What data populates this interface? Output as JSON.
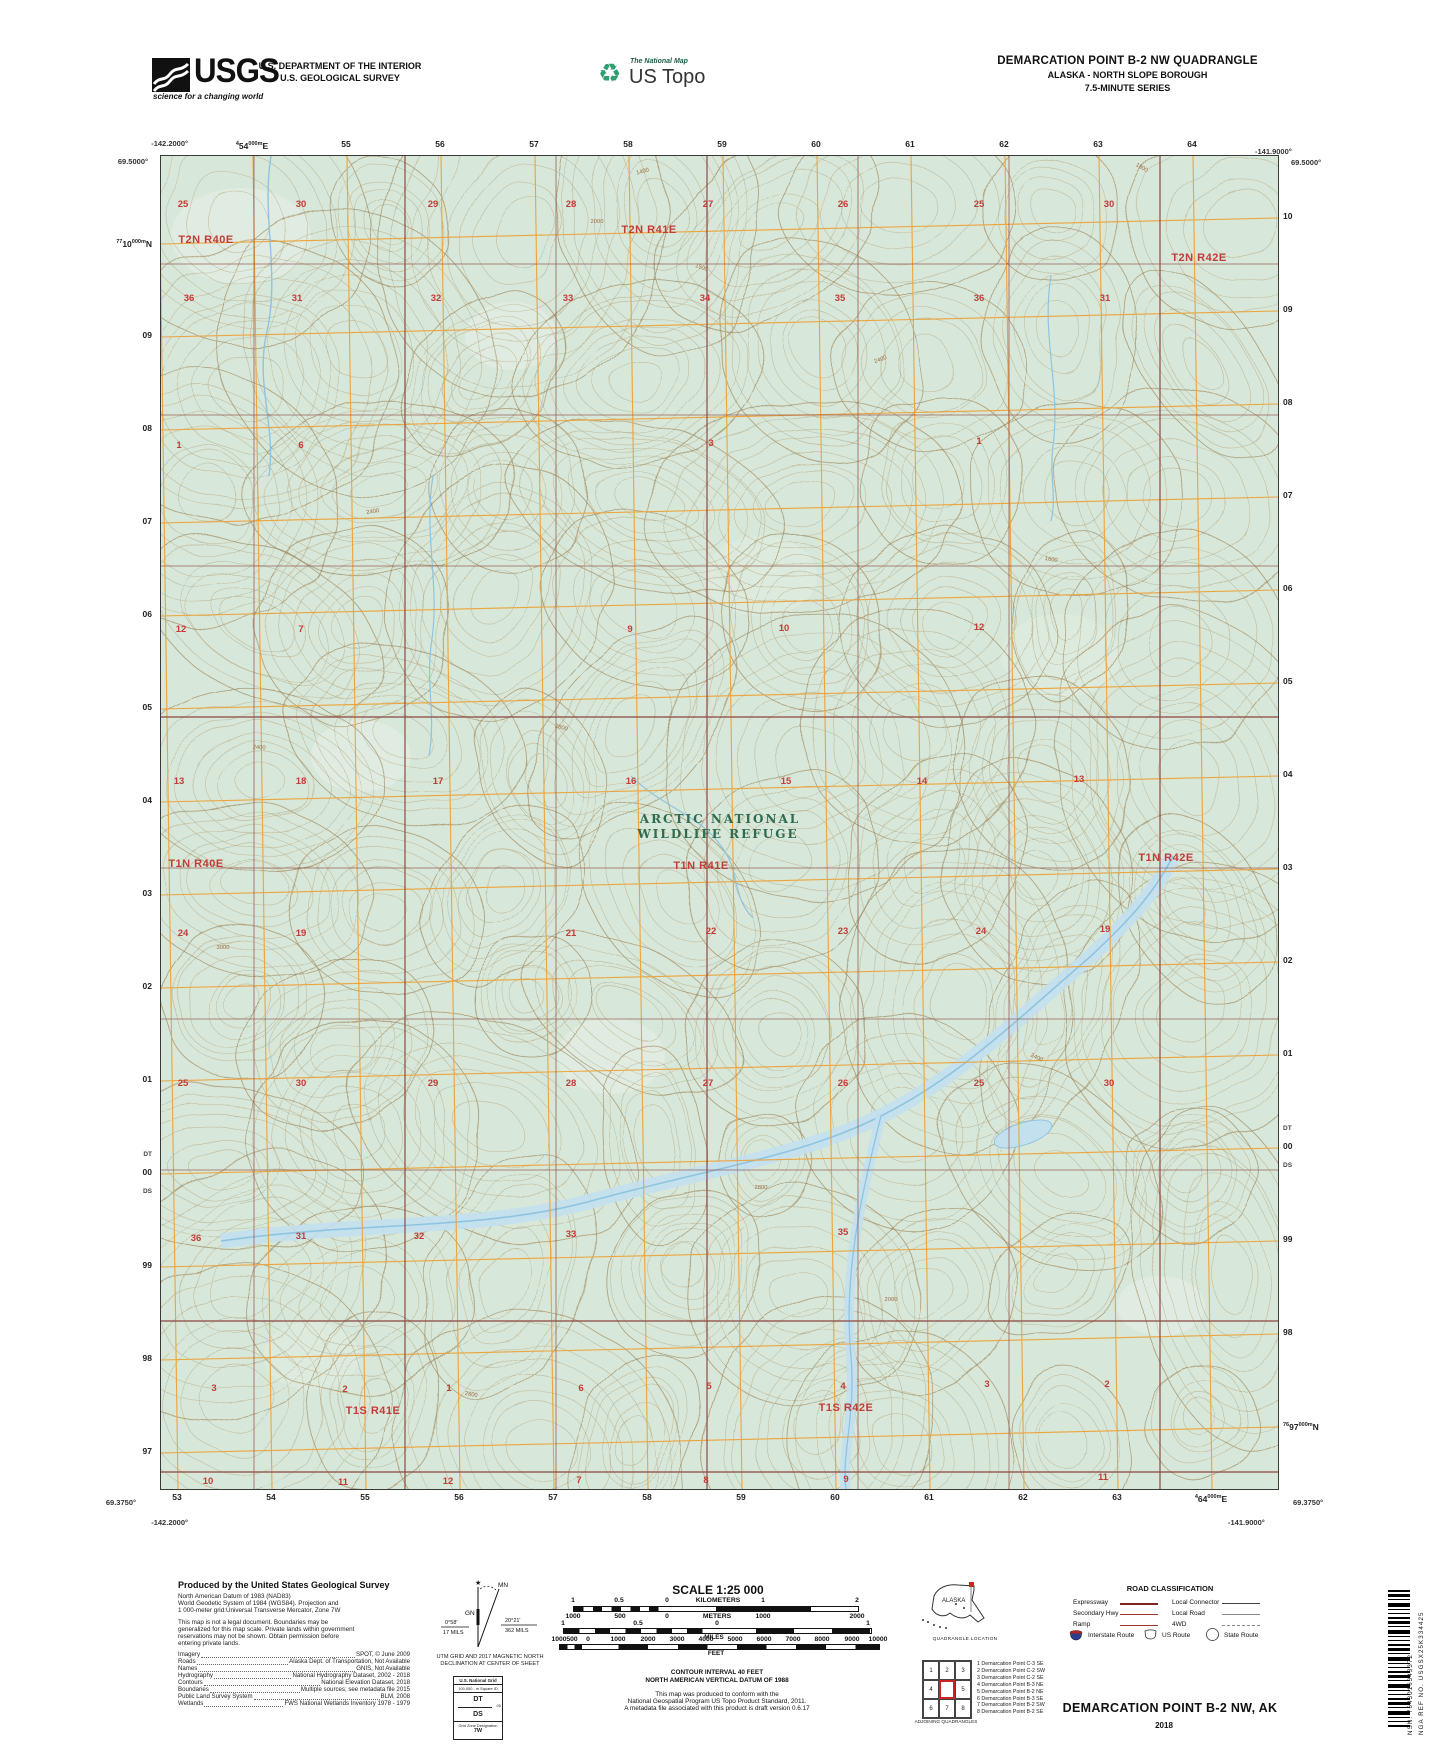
{
  "header": {
    "usgs": {
      "name": "USGS",
      "tagline": "science for a changing world"
    },
    "dept1": "U.S. DEPARTMENT OF THE INTERIOR",
    "dept2": "U.S. GEOLOGICAL SURVEY",
    "natmap": "The National Map",
    "ustopo": "US Topo",
    "q1": "DEMARCATION POINT B-2 NW QUADRANGLE",
    "q2": "ALASKA - NORTH SLOPE BOROUGH",
    "q3": "7.5-MINUTE SERIES"
  },
  "collar": {
    "corners": {
      "tl_lon": "-142.2000°",
      "tl_lat": "69.5000°",
      "tr_lon": "-141.9000°",
      "tr_lat": "69.5000°",
      "bl_lat": "69.3750°",
      "bl_lon": "-142.2000°",
      "br_lon": "-141.9000°",
      "br_lat": "69.3750°"
    },
    "top": [
      {
        "x": 252,
        "pre": "4",
        "t": "54",
        "sup": "000m",
        "suf": "E"
      },
      {
        "x": 346,
        "t": "55"
      },
      {
        "x": 440,
        "t": "56"
      },
      {
        "x": 534,
        "t": "57"
      },
      {
        "x": 628,
        "t": "58"
      },
      {
        "x": 722,
        "t": "59"
      },
      {
        "x": 816,
        "t": "60"
      },
      {
        "x": 910,
        "t": "61"
      },
      {
        "x": 1004,
        "t": "62"
      },
      {
        "x": 1098,
        "t": "63"
      },
      {
        "x": 1192,
        "t": "64"
      }
    ],
    "bottom": [
      {
        "x": 177,
        "t": "53"
      },
      {
        "x": 271,
        "t": "54"
      },
      {
        "x": 365,
        "t": "55"
      },
      {
        "x": 459,
        "t": "56"
      },
      {
        "x": 553,
        "t": "57"
      },
      {
        "x": 647,
        "t": "58"
      },
      {
        "x": 741,
        "t": "59"
      },
      {
        "x": 835,
        "t": "60"
      },
      {
        "x": 929,
        "t": "61"
      },
      {
        "x": 1023,
        "t": "62"
      },
      {
        "x": 1117,
        "t": "63"
      },
      {
        "x": 1211,
        "pre": "4",
        "t": "64",
        "sup": "000m",
        "suf": "E"
      }
    ],
    "left": [
      {
        "y": 243,
        "pre": "77",
        "t": "10",
        "sup": "000m",
        "suf": "N"
      },
      {
        "y": 336,
        "t": "09"
      },
      {
        "y": 429,
        "t": "08"
      },
      {
        "y": 522,
        "t": "07"
      },
      {
        "y": 615,
        "t": "06"
      },
      {
        "y": 708,
        "t": "05"
      },
      {
        "y": 801,
        "t": "04"
      },
      {
        "y": 894,
        "t": "03"
      },
      {
        "y": 987,
        "t": "02"
      },
      {
        "y": 1080,
        "t": "01"
      },
      {
        "y": 1155,
        "t": "DT",
        "sq": true
      },
      {
        "y": 1173,
        "t": "00"
      },
      {
        "y": 1192,
        "t": "DS",
        "sq": true
      },
      {
        "y": 1266,
        "t": "99"
      },
      {
        "y": 1359,
        "t": "98"
      },
      {
        "y": 1452,
        "t": "97"
      }
    ],
    "right": [
      {
        "y": 217,
        "t": "10"
      },
      {
        "y": 310,
        "t": "09"
      },
      {
        "y": 403,
        "t": "08"
      },
      {
        "y": 496,
        "t": "07"
      },
      {
        "y": 589,
        "t": "06"
      },
      {
        "y": 682,
        "t": "05"
      },
      {
        "y": 775,
        "t": "04"
      },
      {
        "y": 868,
        "t": "03"
      },
      {
        "y": 961,
        "t": "02"
      },
      {
        "y": 1054,
        "t": "01"
      },
      {
        "y": 1129,
        "t": "DT",
        "sq": true
      },
      {
        "y": 1147,
        "t": "00"
      },
      {
        "y": 1166,
        "t": "DS",
        "sq": true
      },
      {
        "y": 1240,
        "t": "99"
      },
      {
        "y": 1333,
        "t": "98"
      },
      {
        "y": 1426,
        "pre": "76",
        "t": "97",
        "sup": "000m",
        "suf": "N"
      }
    ]
  },
  "map": {
    "refuge1": "ARCTIC NATIONAL",
    "refuge2": "WILDLIFE REFUGE",
    "townships": [
      {
        "t": "T2N R40E",
        "x": 205,
        "y": 242
      },
      {
        "t": "T2N R41E",
        "x": 648,
        "y": 232
      },
      {
        "t": "T2N R42E",
        "x": 1198,
        "y": 260
      },
      {
        "t": "T1N R40E",
        "x": 195,
        "y": 866
      },
      {
        "t": "T1N R41E",
        "x": 700,
        "y": 868
      },
      {
        "t": "T1N R42E",
        "x": 1165,
        "y": 860
      },
      {
        "t": "T1S R41E",
        "x": 372,
        "y": 1413
      },
      {
        "t": "T1S R42E",
        "x": 845,
        "y": 1410
      }
    ],
    "sections": [
      {
        "t": "25",
        "x": 182,
        "y": 206
      },
      {
        "t": "30",
        "x": 300,
        "y": 206
      },
      {
        "t": "29",
        "x": 432,
        "y": 206
      },
      {
        "t": "28",
        "x": 570,
        "y": 206
      },
      {
        "t": "27",
        "x": 707,
        "y": 206
      },
      {
        "t": "26",
        "x": 842,
        "y": 206
      },
      {
        "t": "25",
        "x": 978,
        "y": 206
      },
      {
        "t": "30",
        "x": 1108,
        "y": 206
      },
      {
        "t": "36",
        "x": 188,
        "y": 300
      },
      {
        "t": "31",
        "x": 296,
        "y": 300
      },
      {
        "t": "32",
        "x": 435,
        "y": 300
      },
      {
        "t": "33",
        "x": 567,
        "y": 300
      },
      {
        "t": "34",
        "x": 704,
        "y": 300
      },
      {
        "t": "35",
        "x": 839,
        "y": 300
      },
      {
        "t": "36",
        "x": 978,
        "y": 300
      },
      {
        "t": "31",
        "x": 1104,
        "y": 300
      },
      {
        "t": "1",
        "x": 178,
        "y": 447
      },
      {
        "t": "6",
        "x": 300,
        "y": 447
      },
      {
        "t": "3",
        "x": 710,
        "y": 445
      },
      {
        "t": "1",
        "x": 978,
        "y": 443
      },
      {
        "t": "12",
        "x": 180,
        "y": 631
      },
      {
        "t": "7",
        "x": 300,
        "y": 631
      },
      {
        "t": "9",
        "x": 629,
        "y": 631
      },
      {
        "t": "10",
        "x": 783,
        "y": 630
      },
      {
        "t": "12",
        "x": 978,
        "y": 629
      },
      {
        "t": "13",
        "x": 178,
        "y": 783
      },
      {
        "t": "18",
        "x": 300,
        "y": 783
      },
      {
        "t": "17",
        "x": 437,
        "y": 783
      },
      {
        "t": "16",
        "x": 630,
        "y": 783
      },
      {
        "t": "15",
        "x": 785,
        "y": 783
      },
      {
        "t": "14",
        "x": 921,
        "y": 783
      },
      {
        "t": "13",
        "x": 1078,
        "y": 781
      },
      {
        "t": "24",
        "x": 182,
        "y": 935
      },
      {
        "t": "19",
        "x": 300,
        "y": 935
      },
      {
        "t": "21",
        "x": 570,
        "y": 935
      },
      {
        "t": "22",
        "x": 710,
        "y": 933
      },
      {
        "t": "23",
        "x": 842,
        "y": 933
      },
      {
        "t": "24",
        "x": 980,
        "y": 933
      },
      {
        "t": "19",
        "x": 1104,
        "y": 931
      },
      {
        "t": "25",
        "x": 182,
        "y": 1085
      },
      {
        "t": "30",
        "x": 300,
        "y": 1085
      },
      {
        "t": "29",
        "x": 432,
        "y": 1085
      },
      {
        "t": "28",
        "x": 570,
        "y": 1085
      },
      {
        "t": "27",
        "x": 707,
        "y": 1085
      },
      {
        "t": "26",
        "x": 842,
        "y": 1085
      },
      {
        "t": "25",
        "x": 978,
        "y": 1085
      },
      {
        "t": "30",
        "x": 1108,
        "y": 1085
      },
      {
        "t": "36",
        "x": 195,
        "y": 1240
      },
      {
        "t": "31",
        "x": 300,
        "y": 1238
      },
      {
        "t": "32",
        "x": 418,
        "y": 1238
      },
      {
        "t": "33",
        "x": 570,
        "y": 1236
      },
      {
        "t": "35",
        "x": 842,
        "y": 1234
      },
      {
        "t": "3",
        "x": 213,
        "y": 1390
      },
      {
        "t": "2",
        "x": 344,
        "y": 1391
      },
      {
        "t": "1",
        "x": 448,
        "y": 1390
      },
      {
        "t": "6",
        "x": 580,
        "y": 1390
      },
      {
        "t": "5",
        "x": 708,
        "y": 1388
      },
      {
        "t": "4",
        "x": 842,
        "y": 1388
      },
      {
        "t": "3",
        "x": 986,
        "y": 1386
      },
      {
        "t": "2",
        "x": 1106,
        "y": 1386
      },
      {
        "t": "10",
        "x": 207,
        "y": 1483
      },
      {
        "t": "11",
        "x": 342,
        "y": 1484
      },
      {
        "t": "12",
        "x": 447,
        "y": 1483
      },
      {
        "t": "7",
        "x": 578,
        "y": 1482
      },
      {
        "t": "8",
        "x": 705,
        "y": 1482
      },
      {
        "t": "9",
        "x": 845,
        "y": 1481
      },
      {
        "t": "11",
        "x": 1102,
        "y": 1479
      }
    ],
    "contour_labels": [
      {
        "t": "1400",
        "x": 642,
        "y": 172,
        "r": -15
      },
      {
        "t": "1500",
        "x": 700,
        "y": 268,
        "r": 20
      },
      {
        "t": "2000",
        "x": 596,
        "y": 222,
        "r": 0
      },
      {
        "t": "1800",
        "x": 1140,
        "y": 168,
        "r": 30
      },
      {
        "t": "2400",
        "x": 372,
        "y": 512,
        "r": -10
      },
      {
        "t": "2800",
        "x": 560,
        "y": 728,
        "r": 15
      },
      {
        "t": "2400",
        "x": 258,
        "y": 748,
        "r": 5
      },
      {
        "t": "3000",
        "x": 222,
        "y": 948,
        "r": 0
      },
      {
        "t": "2400",
        "x": 880,
        "y": 360,
        "r": -20
      },
      {
        "t": "1600",
        "x": 1050,
        "y": 560,
        "r": 10
      },
      {
        "t": "2800",
        "x": 760,
        "y": 1188,
        "r": 0
      },
      {
        "t": "3000",
        "x": 128,
        "y": 1248,
        "r": -5
      },
      {
        "t": "2400",
        "x": 1035,
        "y": 1058,
        "r": 25
      },
      {
        "t": "2000",
        "x": 890,
        "y": 1300,
        "r": 0
      },
      {
        "t": "2800",
        "x": 470,
        "y": 1395,
        "r": 10
      }
    ]
  },
  "footer": {
    "credits": {
      "title": "Produced by the United States Geological Survey",
      "block1": [
        "North American Datum of 1983 (NAD83)",
        "World Geodetic System of 1984 (WGS84).  Projection and",
        "1 000-meter grid:Universal Transverse Mercator, Zone 7W"
      ],
      "block2": [
        "This map is not a legal document. Boundaries may be",
        "generalized for this map scale. Private lands within government",
        "reservations may not be shown. Obtain permission before",
        "entering private lands."
      ],
      "rows": [
        {
          "k": "Imagery",
          "v": "SPOT,  ©  June  2009"
        },
        {
          "k": "Roads",
          "v": "Alaska Dept. of Transportation, Not Available"
        },
        {
          "k": "Names",
          "v": "GNIS, Not Available"
        },
        {
          "k": "Hydrography",
          "v": "National Hydrography Dataset, 2002 - 2018"
        },
        {
          "k": "Contours",
          "v": "National Elevation Dataset, 2018"
        },
        {
          "k": "Boundaries",
          "v": "Multiple sources; see metadata file 2015"
        },
        {
          "k": "Public Land Survey System",
          "v": "BLM, 2008"
        },
        {
          "k": "Wetlands",
          "v": "FWS National Wetlands Inventory 1978 - 1979"
        }
      ]
    },
    "declination": {
      "gn": "GN",
      "mn": "MN",
      "star": "★",
      "left1": "0°58'",
      "left2": "17 MILS",
      "right1": "20°21'",
      "right2": "362 MILS",
      "cap1": "UTM GRID AND 2017 MAGNETIC NORTH",
      "cap2": "DECLINATION AT CENTER OF SHEET"
    },
    "usng": {
      "title": "U.S. National Grid",
      "sub": "100,000 - m Square ID",
      "sq1": "DT",
      "line_label": "00",
      "sq2": "DS",
      "gzd_label": "Grid Zone Designation",
      "gzd": "7W"
    },
    "scale": {
      "title": "SCALE 1:25 000",
      "km_labels": [
        {
          "t": "1",
          "x": 573
        },
        {
          "t": "0.5",
          "x": 619
        },
        {
          "t": "0",
          "x": 667
        },
        {
          "t": "KILOMETERS",
          "x": 718
        },
        {
          "t": "1",
          "x": 763
        },
        {
          "t": "2",
          "x": 857
        }
      ],
      "m_labels": [
        {
          "t": "1000",
          "x": 573
        },
        {
          "t": "500",
          "x": 620
        },
        {
          "t": "0",
          "x": 667
        },
        {
          "t": "METERS",
          "x": 717
        },
        {
          "t": "1000",
          "x": 763
        },
        {
          "t": "2000",
          "x": 857
        }
      ],
      "mi_labels": [
        {
          "t": "1",
          "x": 563
        },
        {
          "t": "0.5",
          "x": 638
        },
        {
          "t": "0",
          "x": 717
        },
        {
          "t": "1",
          "x": 868
        }
      ],
      "mi_word": "MILES",
      "ft_labels": [
        {
          "t": "1000",
          "x": 559
        },
        {
          "t": "500",
          "x": 572
        },
        {
          "t": "0",
          "x": 588
        },
        {
          "t": "1000",
          "x": 618
        },
        {
          "t": "2000",
          "x": 648
        },
        {
          "t": "3000",
          "x": 677
        },
        {
          "t": "4000",
          "x": 706
        },
        {
          "t": "5000",
          "x": 735
        },
        {
          "t": "6000",
          "x": 764
        },
        {
          "t": "7000",
          "x": 793
        },
        {
          "t": "8000",
          "x": 822
        },
        {
          "t": "9000",
          "x": 852
        },
        {
          "t": "10000",
          "x": 878
        }
      ],
      "ft_word": "FEET",
      "note1": "CONTOUR INTERVAL 40 FEET",
      "note2": "NORTH AMERICAN VERTICAL DATUM OF 1988",
      "note3": "This map was produced to conform with the",
      "note4": "National Geospatial Program US Topo Product Standard, 2011.",
      "note5": "A metadata file associated with this product is draft version 0.6.17"
    },
    "inset": {
      "state": "ALASKA",
      "caption": "QUADRANGLE LOCATION"
    },
    "adjoining": {
      "cells": [
        "1",
        "2",
        "3",
        "4",
        "",
        "5",
        "6",
        "7",
        "8"
      ],
      "caption": "ADJOINING QUADRANGLES",
      "list": [
        "1 Demarcation Point C-3 SE",
        "2 Demarcation Point C-2 SW",
        "3 Demarcation Point C-2 SE",
        "4 Demarcation Point B-3 NE",
        "5 Demarcation Point B-2 NE",
        "6 Demarcation Point B-3 SE",
        "7 Demarcation Point B-2 SW",
        "8 Demarcation Point B-2 SE"
      ]
    },
    "roads": {
      "title": "ROAD CLASSIFICATION",
      "rows": [
        {
          "l": "Expressway",
          "r": "Local Connector"
        },
        {
          "l": "Secondary Hwy",
          "r": "Local Road"
        },
        {
          "l": "Ramp",
          "r": "4WD"
        }
      ],
      "badge1": "Interstate Route",
      "badge2": "US Route",
      "badge3": "State Route"
    },
    "sheet": {
      "name": "DEMARCATION POINT B-2 NW,  AK",
      "year": "2018"
    },
    "barcode": {
      "nsn": "NSN.",
      "nsn_num": "7643016343372",
      "nga": "NGA REF NO.",
      "nga_num": "USGSX25K334425"
    }
  },
  "colors": {
    "map_bg": "#d7e7d9",
    "grid_orange": "#eda43c",
    "plss": "#8e4b43",
    "section_red": "#c33b36",
    "refuge_green": "#2e6b4f",
    "water": "#8fc4e0",
    "water_fill": "#c3e0ef",
    "contour": "#a8905f"
  }
}
